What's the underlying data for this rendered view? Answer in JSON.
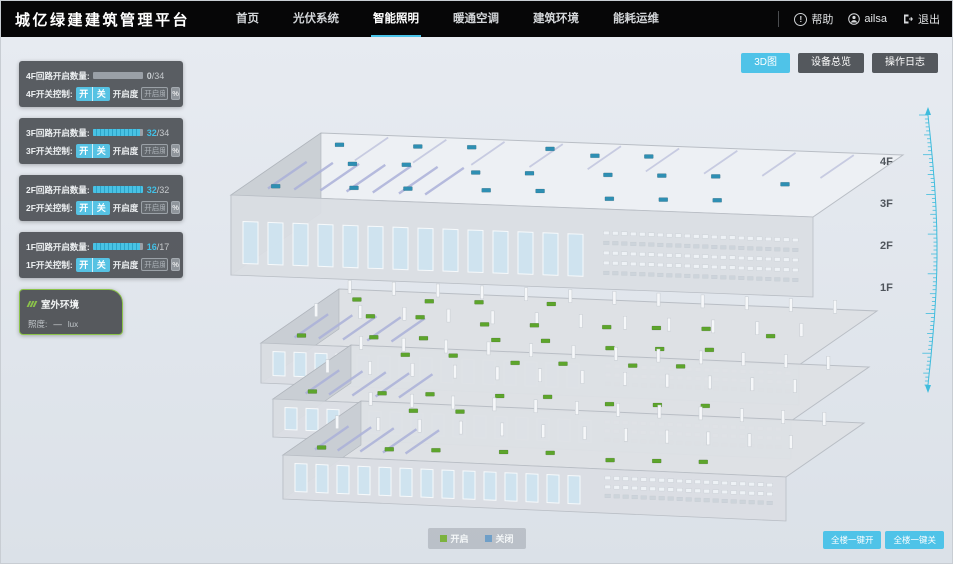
{
  "app": {
    "title": "城亿绿建建筑管理平台"
  },
  "nav": {
    "items": [
      {
        "label": "首页",
        "active": false
      },
      {
        "label": "光伏系统",
        "active": false
      },
      {
        "label": "智能照明",
        "active": true
      },
      {
        "label": "暖通空调",
        "active": false
      },
      {
        "label": "建筑环境",
        "active": false
      },
      {
        "label": "能耗运维",
        "active": false
      }
    ],
    "help_label": "帮助",
    "username": "ailsa",
    "logout_label": "退出"
  },
  "view_toolbar": {
    "buttons": [
      {
        "label": "3D图",
        "active": true
      },
      {
        "label": "设备总览",
        "active": false
      },
      {
        "label": "操作日志",
        "active": false
      }
    ]
  },
  "floor_panels": [
    {
      "floor": "4F",
      "count_label": "4F回路开启数量:",
      "open": "0",
      "total_label": "/34",
      "pct": 0,
      "open_color": "#ccd1d5",
      "control_label": "4F开关控制:",
      "on_label": "开",
      "off_label": "关",
      "openness_label": "开启度",
      "openness_placeholder": "开启度",
      "percent_label": "%"
    },
    {
      "floor": "3F",
      "count_label": "3F回路开启数量:",
      "open": "32",
      "total_label": "/34",
      "pct": 94,
      "open_color": "#41c0e6",
      "control_label": "3F开关控制:",
      "on_label": "开",
      "off_label": "关",
      "openness_label": "开启度",
      "openness_placeholder": "开启度",
      "percent_label": "%"
    },
    {
      "floor": "2F",
      "count_label": "2F回路开启数量:",
      "open": "32",
      "total_label": "/32",
      "pct": 100,
      "open_color": "#41c0e6",
      "control_label": "2F开关控制:",
      "on_label": "开",
      "off_label": "关",
      "openness_label": "开启度",
      "openness_placeholder": "开启度",
      "percent_label": "%"
    },
    {
      "floor": "1F",
      "count_label": "1F回路开启数量:",
      "open": "16",
      "total_label": "/17",
      "pct": 94,
      "open_color": "#41c0e6",
      "control_label": "1F开关控制:",
      "on_label": "开",
      "off_label": "关",
      "openness_label": "开启度",
      "openness_placeholder": "开启度",
      "percent_label": "%"
    }
  ],
  "outdoor": {
    "title": "室外环境",
    "illuminance_label": "照度:",
    "value": "—",
    "unit": "lux"
  },
  "floor_axis": [
    "4F",
    "3F",
    "2F",
    "1F"
  ],
  "legend": {
    "on_label": "开启",
    "off_label": "关闭",
    "on_color": "#7cb23e",
    "off_color": "#6f9fc8"
  },
  "bulk_controls": {
    "all_on_label": "全楼一键开",
    "all_off_label": "全楼一键关"
  },
  "colors": {
    "accent": "#4fc3e8",
    "nav_underline": "#49c3e8",
    "marker_on": "#5da52c",
    "marker_off": "#2e8fb3",
    "ruler": "#3fbcdd"
  },
  "building": {
    "floors": [
      {
        "id": "4F",
        "markers_on": 0,
        "markers_off": 22
      },
      {
        "id": "3F",
        "markers_on": 19,
        "markers_off": 1
      },
      {
        "id": "2F",
        "markers_on": 14,
        "markers_off": 0
      },
      {
        "id": "1F",
        "markers_on": 9,
        "markers_off": 1
      }
    ]
  }
}
